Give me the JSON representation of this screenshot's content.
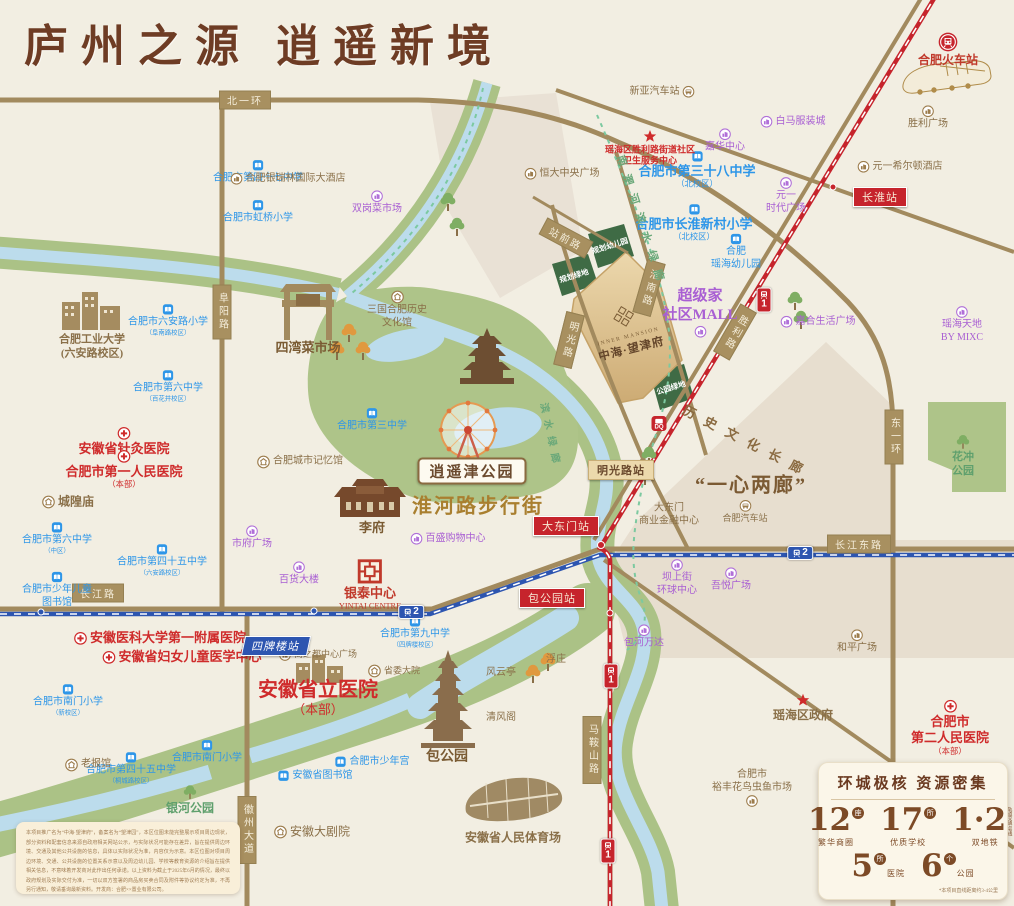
{
  "title": {
    "text": "庐州之源  逍遥新境"
  },
  "colors": {
    "school_blue": "#2e96e8",
    "hospital_red": "#cf2b2b",
    "mall_purple": "#a95fd3",
    "landmark_brown": "#8a7049",
    "road_tan": "#a89060",
    "metro1_red": "#c6242c",
    "metro2_blue": "#2d55b0",
    "park_green": "#aec489",
    "river_blue": "#bcdcec",
    "project_gold": "#d9bf92"
  },
  "project": {
    "en": "INNER MANSION",
    "cn": "中海·望津府"
  },
  "big_labels": {
    "xiaoyaojin": "逍遥津公园",
    "huaihe": "淮河路步行街",
    "yixin": "“一心两廊”"
  },
  "corridors": [
    {
      "t": "历史文化长廊",
      "x": 748,
      "y": 441,
      "r": 27,
      "f": 13,
      "ls": 11,
      "col": "#8a6a40"
    },
    {
      "t": "南淝河滨水绿廊",
      "x": 642,
      "y": 222,
      "r": 72,
      "f": 11,
      "ls": 9,
      "col": "#6aa879"
    },
    {
      "t": "滨水绿廊",
      "x": 552,
      "y": 436,
      "r": 78,
      "f": 10,
      "ls": 7,
      "col": "#6aa879"
    }
  ],
  "green_blocks": [
    {
      "lines": [
        "规划",
        "幼儿园"
      ],
      "x": 610,
      "y": 246
    },
    {
      "lines": [
        "规划",
        "绿地"
      ],
      "x": 574,
      "y": 276
    },
    {
      "lines": [
        "公园",
        "绿地"
      ],
      "x": 671,
      "y": 388
    }
  ],
  "road_labels": [
    {
      "t": "北一环",
      "x": 245,
      "y": 100
    },
    {
      "t": "长江路",
      "x": 98,
      "y": 593
    },
    {
      "t": "长江东路",
      "x": 859,
      "y": 544
    },
    {
      "t": "阜阳路",
      "x": 222,
      "y": 312,
      "v": 1
    },
    {
      "t": "东一环",
      "x": 894,
      "y": 437,
      "v": 1
    },
    {
      "t": "徽州大道",
      "x": 247,
      "y": 830,
      "v": 1
    },
    {
      "t": "马鞍山路",
      "x": 592,
      "y": 750,
      "v": 1
    },
    {
      "t": "明光路",
      "x": 569,
      "y": 340,
      "v": 1,
      "r": 14
    },
    {
      "t": "淮南路",
      "x": 649,
      "y": 288,
      "v": 1,
      "r": 16
    },
    {
      "t": "胜利路",
      "x": 735,
      "y": 332,
      "v": 1,
      "r": 30
    },
    {
      "t": "站前路",
      "x": 566,
      "y": 238,
      "r": 28
    }
  ],
  "stations": [
    {
      "t": "长淮站",
      "x": 880,
      "y": 197,
      "c": "red"
    },
    {
      "t": "大东门站",
      "x": 566,
      "y": 526,
      "c": "red"
    },
    {
      "t": "包公园站",
      "x": 552,
      "y": 598,
      "c": "red"
    },
    {
      "t": "四牌楼站",
      "x": 276,
      "y": 646,
      "c": "blue"
    },
    {
      "t": "明光路站",
      "x": 621,
      "y": 470,
      "c": "tan"
    }
  ],
  "metro_badges": [
    {
      "l": "2",
      "x": 800,
      "y": 553,
      "o": "h"
    },
    {
      "l": "2",
      "x": 411,
      "y": 612,
      "o": "h"
    },
    {
      "l": "1",
      "x": 764,
      "y": 300,
      "o": "v"
    },
    {
      "l": "1",
      "x": 611,
      "y": 676,
      "o": "v"
    },
    {
      "l": "1",
      "x": 608,
      "y": 851,
      "o": "v"
    }
  ],
  "pois": [
    {
      "t": "合肥市第四十七中学",
      "x": 258,
      "y": 172,
      "c": "sch",
      "i": "book"
    },
    {
      "t": "合肥市虹桥小学",
      "x": 258,
      "y": 212,
      "c": "sch",
      "i": "book"
    },
    {
      "t": "合肥市六安路小学",
      "s": "（阜南路校区）",
      "x": 168,
      "y": 320,
      "c": "sch",
      "i": "book"
    },
    {
      "t": "合肥市第六中学",
      "s": "（百花井校区）",
      "x": 168,
      "y": 386,
      "c": "sch",
      "i": "book"
    },
    {
      "t": "合肥市第六中学",
      "s": "（中区）",
      "x": 57,
      "y": 538,
      "c": "sch",
      "i": "book"
    },
    {
      "t": "合肥市第四十五中学",
      "s": "（六安路校区）",
      "x": 162,
      "y": 560,
      "c": "sch",
      "i": "book"
    },
    {
      "t": "合肥市少年儿童图书馆",
      "x": 57,
      "y": 590,
      "c": "sch",
      "i": "book",
      "w": 76
    },
    {
      "t": "合肥市第三中学",
      "x": 372,
      "y": 420,
      "c": "sch",
      "i": "book"
    },
    {
      "t": "合肥市第三十八中学",
      "s": "（北校区）",
      "x": 697,
      "y": 170,
      "c": "sch",
      "i": "book",
      "f": 13,
      "b": 1
    },
    {
      "t": "合肥市长淮新村小学",
      "s": "（北校区）",
      "x": 694,
      "y": 223,
      "c": "sch",
      "i": "book",
      "f": 13,
      "b": 1
    },
    {
      "t": [
        "合肥",
        "瑶海幼儿园"
      ],
      "x": 736,
      "y": 252,
      "c": "sch",
      "i": "book"
    },
    {
      "t": "合肥市南门小学",
      "s": "（新校区）",
      "x": 68,
      "y": 700,
      "c": "sch",
      "i": "book"
    },
    {
      "t": "合肥市第四十五中学",
      "s": "（桐城路校区）",
      "x": 131,
      "y": 768,
      "c": "sch",
      "i": "book"
    },
    {
      "t": "合肥市南门小学",
      "x": 207,
      "y": 752,
      "c": "sch",
      "i": "book"
    },
    {
      "t": "合肥市第九中学",
      "s": "（四牌楼校区）",
      "x": 415,
      "y": 632,
      "c": "sch",
      "i": "book"
    },
    {
      "t": "合肥市少年宫",
      "x": 372,
      "y": 762,
      "c": "sch",
      "i": "book",
      "p": "left"
    },
    {
      "t": "安徽省图书馆",
      "x": 315,
      "y": 776,
      "c": "sch",
      "i": "book",
      "p": "left"
    },
    {
      "t": "安徽省针灸医院",
      "x": 124,
      "y": 442,
      "c": "hos",
      "i": "cross",
      "f": 13
    },
    {
      "t": "合肥市第一人民医院",
      "s": "（本部）",
      "x": 124,
      "y": 470,
      "c": "hos",
      "i": "cross",
      "f": 13
    },
    {
      "t": [
        "瑶海区胜利路街道社区",
        "卫生服务中心"
      ],
      "x": 650,
      "y": 148,
      "c": "hos",
      "i": "star",
      "f": 9
    },
    {
      "t": "安徽医科大学第一附属医院",
      "x": 160,
      "y": 638,
      "c": "hos",
      "i": "cross",
      "p": "left",
      "f": 13
    },
    {
      "t": "安徽省妇女儿童医学中心",
      "x": 182,
      "y": 657,
      "c": "hos",
      "i": "cross",
      "p": "left",
      "f": 13
    },
    {
      "t": [
        "合肥市",
        "第二人民医院"
      ],
      "s": "（本部）",
      "x": 950,
      "y": 728,
      "c": "hos",
      "i": "cross",
      "f": 13
    },
    {
      "t": "安徽省立医院",
      "s": "（本部）",
      "x": 318,
      "y": 698,
      "c": "hos",
      "f": 20
    },
    {
      "t": "双岗菜市场",
      "x": 377,
      "y": 203,
      "c": "mall",
      "i": "mall"
    },
    {
      "t": "白马服装城",
      "x": 793,
      "y": 122,
      "c": "mall",
      "i": "mall",
      "p": "left"
    },
    {
      "t": "嘉华中心",
      "x": 725,
      "y": 141,
      "c": "mall",
      "i": "mall"
    },
    {
      "t": [
        "元一",
        "时代广场"
      ],
      "x": 786,
      "y": 196,
      "c": "mall",
      "i": "mall"
    },
    {
      "t": [
        "超级家",
        "社区MALL"
      ],
      "x": 700,
      "y": 312,
      "c": "mall",
      "i": "mall",
      "p": "bottom",
      "f": 15,
      "b": 1
    },
    {
      "t": "嘉合生活广场",
      "x": 818,
      "y": 322,
      "c": "mall",
      "i": "mall",
      "p": "left"
    },
    {
      "t": [
        "瑶海天地",
        "BY MIXC"
      ],
      "x": 962,
      "y": 325,
      "c": "mall",
      "i": "mall"
    },
    {
      "t": "市府广场",
      "x": 252,
      "y": 538,
      "c": "mall",
      "i": "mall"
    },
    {
      "t": "百货大楼",
      "x": 299,
      "y": 574,
      "c": "mall",
      "i": "mall"
    },
    {
      "t": "百盛购物中心",
      "x": 448,
      "y": 539,
      "c": "mall",
      "i": "mall",
      "p": "left"
    },
    {
      "t": [
        "坝上街",
        "环球中心"
      ],
      "x": 677,
      "y": 578,
      "c": "mall",
      "i": "mall"
    },
    {
      "t": "吾悦广场",
      "x": 731,
      "y": 580,
      "c": "mall",
      "i": "mall"
    },
    {
      "t": "包河万达",
      "x": 644,
      "y": 637,
      "c": "mall",
      "i": "mall"
    },
    {
      "t": "合肥银瑞林国际大酒店",
      "x": 288,
      "y": 179,
      "c": "lm",
      "i": "lmb",
      "p": "left"
    },
    {
      "t": "新亚汽车站",
      "x": 662,
      "y": 92,
      "c": "lm",
      "i": "bus",
      "p": "right"
    },
    {
      "t": "合肥火车站",
      "x": 948,
      "y": 50,
      "c": "red",
      "i": "trainlogo",
      "f": 12
    },
    {
      "t": "胜利广场",
      "x": 928,
      "y": 118,
      "c": "lm",
      "i": "lmb"
    },
    {
      "t": "元一希尔顿酒店",
      "x": 900,
      "y": 167,
      "c": "lm",
      "i": "lmb",
      "p": "left"
    },
    {
      "t": "恒大中央广场",
      "x": 562,
      "y": 174,
      "c": "lm",
      "i": "lmb",
      "p": "left"
    },
    {
      "t": [
        "合肥工业大学",
        "(六安路校区)"
      ],
      "x": 92,
      "y": 347,
      "c": "lm",
      "f": 11,
      "b": 1
    },
    {
      "t": "四湾菜市场",
      "x": 308,
      "y": 348,
      "c": "lmb2",
      "f": 13
    },
    {
      "t": [
        "三国合肥历史",
        "文化馆"
      ],
      "x": 397,
      "y": 310,
      "c": "lm",
      "i": "temple"
    },
    {
      "t": "合肥城市记忆馆",
      "x": 300,
      "y": 462,
      "c": "lm",
      "i": "temple",
      "p": "left"
    },
    {
      "t": "城隍庙",
      "x": 68,
      "y": 502,
      "c": "lm",
      "i": "temple",
      "p": "left",
      "f": 12,
      "b": 1
    },
    {
      "t": "李府",
      "x": 372,
      "y": 528,
      "c": "lmb2",
      "f": 13
    },
    {
      "t": "银泰中心",
      "s": "YINTAI CENTRE",
      "x": 370,
      "y": 585,
      "c": "red",
      "i": "yintai",
      "f": 13
    },
    {
      "t": [
        "大东门",
        "商业金融中心"
      ],
      "x": 669,
      "y": 515,
      "c": "lm"
    },
    {
      "t": "合肥汽车站",
      "x": 745,
      "y": 512,
      "c": "lm",
      "i": "bus",
      "f": 9
    },
    {
      "t": "和平广场",
      "x": 857,
      "y": 642,
      "c": "lm",
      "i": "lmb"
    },
    {
      "t": "瑶海区政府",
      "x": 803,
      "y": 708,
      "c": "lm",
      "i": "star",
      "f": 12,
      "b": 1
    },
    {
      "t": [
        "合肥市",
        "裕丰花鸟虫鱼市场"
      ],
      "x": 752,
      "y": 788,
      "c": "lm",
      "i": "lmb",
      "p": "bottom"
    },
    {
      "t": "商之都中心广场",
      "x": 318,
      "y": 655,
      "c": "lm",
      "i": "lmb",
      "p": "left",
      "f": 9
    },
    {
      "t": "省委大院",
      "x": 394,
      "y": 671,
      "c": "lm",
      "i": "temple",
      "p": "left",
      "f": 9
    },
    {
      "t": "风云亭",
      "x": 501,
      "y": 673,
      "c": "lm"
    },
    {
      "t": "浮庄",
      "x": 556,
      "y": 660,
      "c": "lm"
    },
    {
      "t": "清风阁",
      "x": 501,
      "y": 718,
      "c": "lm"
    },
    {
      "t": "包公园",
      "x": 447,
      "y": 757,
      "c": "lmb2",
      "f": 14
    },
    {
      "t": "老报馆",
      "x": 88,
      "y": 765,
      "c": "lm",
      "i": "temple",
      "p": "left"
    },
    {
      "t": "安徽大剧院",
      "x": 312,
      "y": 832,
      "c": "lm",
      "i": "temple",
      "p": "left",
      "f": 12
    },
    {
      "t": "安徽省人民体育场",
      "x": 513,
      "y": 838,
      "c": "lm",
      "f": 12,
      "b": 1
    },
    {
      "t": "银河公园",
      "x": 190,
      "y": 800,
      "c": "grn",
      "i": "treeg",
      "f": 12
    },
    {
      "t": [
        "花冲",
        "公园"
      ],
      "x": 963,
      "y": 456,
      "c": "grn",
      "i": "treeg",
      "f": 11
    }
  ],
  "stats": {
    "title": "环城极核  资源密集",
    "row1": [
      {
        "n": "12",
        "u": "座",
        "l": "繁华商圈"
      },
      {
        "n": "17",
        "u": "所",
        "l": "优质学校"
      },
      {
        "n": "1·2",
        "u": "",
        "l": "双地铁",
        "s1": "轨道交通1号线",
        "s2": "轨道交通2号线"
      }
    ],
    "row2": [
      {
        "n": "5",
        "u": "所",
        "l": "医院"
      },
      {
        "n": "6",
        "u": "个",
        "l": "公园"
      }
    ],
    "footnote": "*本项目直线距离约3-4公里"
  },
  "disclaimer": {
    "lines": [
      "本项目推广名为“中海·望津府”，备案名为“望津园”，本区位图未能完整展示项目周边现状，部分资料和配套信息来",
      "源自政府相关网站公示，与实际状况可能存在差异，旨在提供周边环境、交通及其他公共设施的信息，具体以实",
      "际状况为准，内容仅为示意。本区位图对项目周边环境、交通、公共设施的位置关系示意以及周边幼儿园、学校",
      "等教育资源的介绍旨在提供相关信息，不意味着开发商对此作出任何承诺。以上资料为截止于2025年6月的情况，",
      "最终以政府规划及实际交付为准，一切以双方签署的商品房买卖合同及附件等协议约定为准，不再另行通知，敬",
      "请垂询最新资料。开发商：合肥××置业有限公司。"
    ]
  },
  "dq_label": "DQ"
}
